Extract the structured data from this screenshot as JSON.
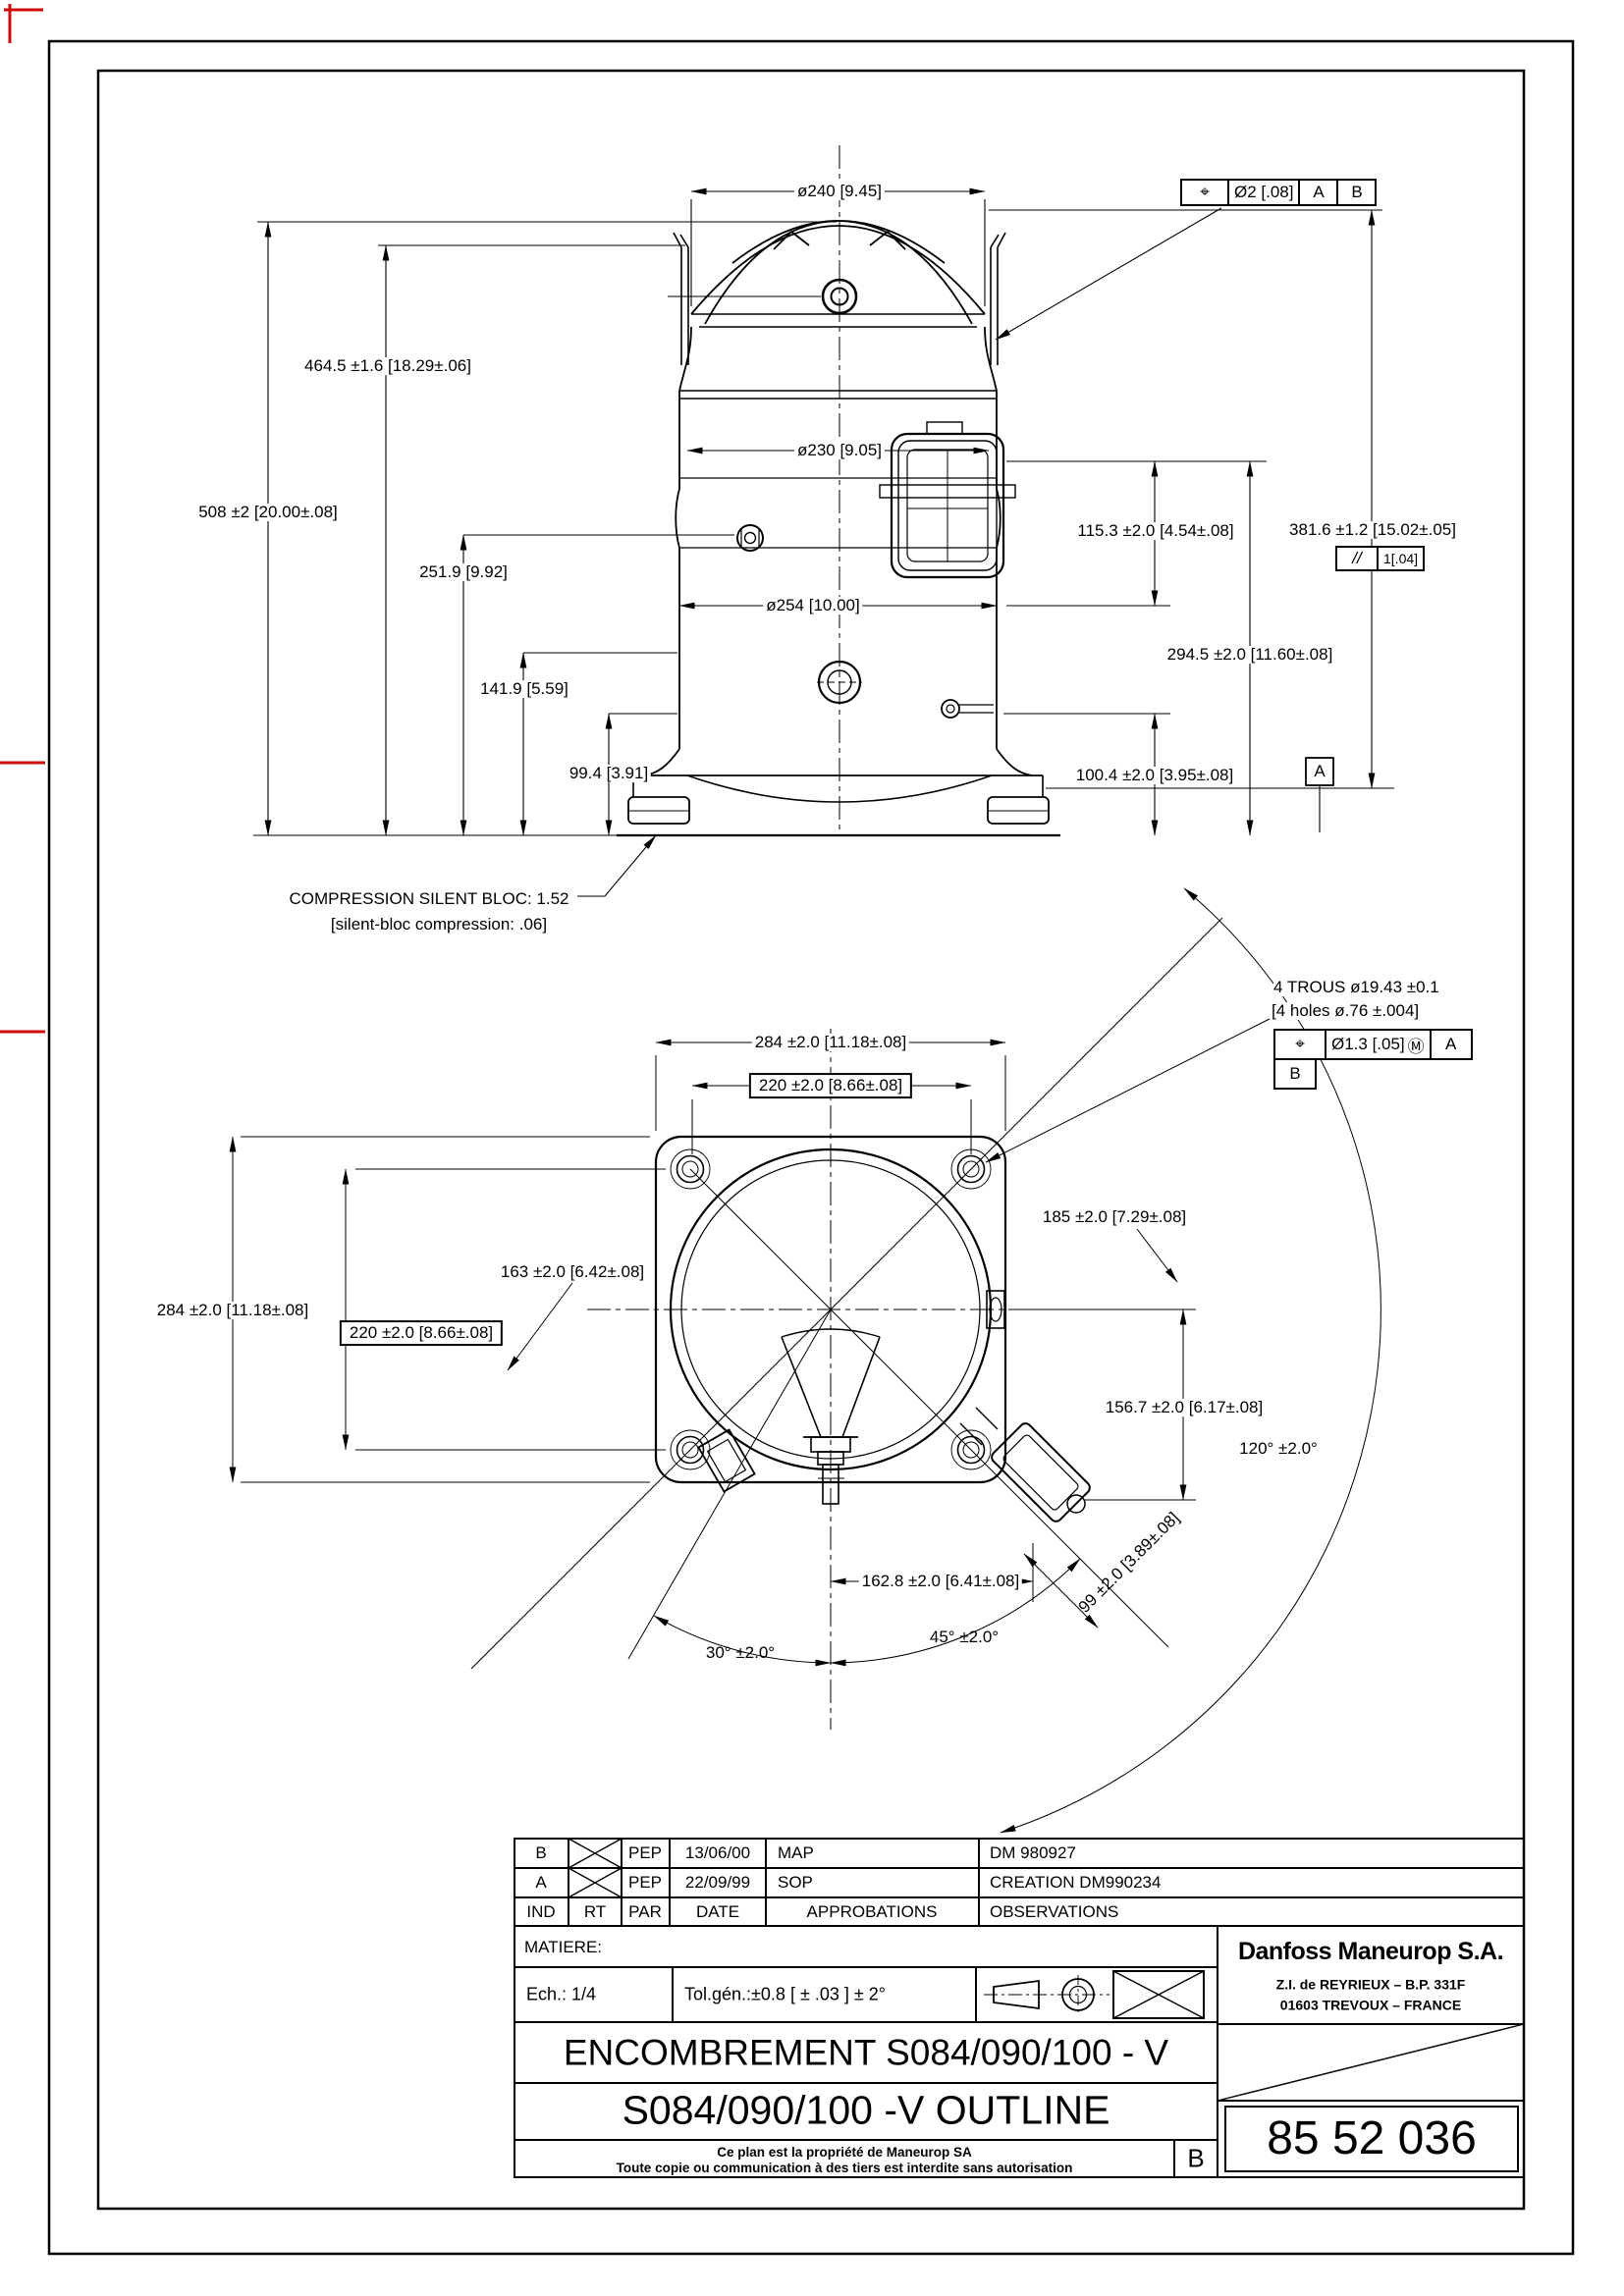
{
  "front_view": {
    "dim_dia240": "ø240 [9.45]",
    "dim_dia230": "ø230 [9.05]",
    "dim_dia254": "ø254 [10.00]",
    "dim_height_508": "508 ±2  [20.00±.08]",
    "dim_height_464": "464.5 ±1.6  [18.29±.06]",
    "dim_height_251": "251.9 [9.92]",
    "dim_height_141": "141.9 [5.59]",
    "dim_height_99": "99.4  [3.91]",
    "dim_height_115": "115.3 ±2.0  [4.54±.08]",
    "dim_height_381": "381.6 ±1.2  [15.02±.05]",
    "parallelism_frame": {
      "symbol": "//",
      "value": "1[.04]"
    },
    "dim_height_294": "294.5 ±2.0  [11.60±.08]",
    "dim_height_100": "100.4 ±2.0  [3.95±.08]",
    "datum_a": "A",
    "position_frame": {
      "symbol": "⌖",
      "value": "Ø2 [.08]",
      "datum_1": "A",
      "datum_2": "B"
    },
    "silent_bloc_note_fr": "COMPRESSION SILENT BLOC: 1.52",
    "silent_bloc_note_en": "[silent-bloc compression:  .06]"
  },
  "bottom_view": {
    "dim_width_284_top": "284 ±2.0  [11.18±.08]",
    "dim_width_220_top": "220 ±2.0  [8.66±.08]",
    "dim_height_284_left": "284 ±2.0  [11.18±.08]",
    "dim_height_220_left": "220 ±2.0  [8.66±.08]",
    "dim_163": "163 ±2.0  [6.42±.08]",
    "dim_185": "185 ±2.0  [7.29±.08]",
    "dim_156": "156.7 ±2.0  [6.17±.08]",
    "angle_120": "120° ±2.0°",
    "dim_162": "162.8 ±2.0  [6.41±.08]",
    "dim_99": "99 ±2.0  [3.89±.08]",
    "angle_45": "45° ±2.0°",
    "angle_30": "30° ±2.0°",
    "holes_note_fr": "4 TROUS ø19.43 ±0.1",
    "holes_note_en": "[4 holes ø.76 ±.004]",
    "position_frame": {
      "symbol": "⌖",
      "value": "Ø1.3 [.05]",
      "modifier": "Ⓜ",
      "datum_1": "A",
      "datum_2": "B"
    }
  },
  "title_block": {
    "revisions": [
      {
        "ind": "B",
        "par": "PEP",
        "date": "13/06/00",
        "approbation": "MAP",
        "observation": "DM 980927"
      },
      {
        "ind": "A",
        "par": "PEP",
        "date": "22/09/99",
        "approbation": "SOP",
        "observation": "CREATION DM990234"
      }
    ],
    "headers": {
      "ind": "IND",
      "rt": "RT",
      "par": "PAR",
      "date": "DATE",
      "approbations": "APPROBATIONS",
      "observations": "OBSERVATIONS"
    },
    "matiere_label": "MATIERE:",
    "scale_label": "Ech.: 1/4",
    "tolerance_label": "Tol.gén.:±0.8    [ ± .03 ]    ± 2°",
    "title_fr": "ENCOMBREMENT S084/090/100 - V",
    "title_en": "S084/090/100 -V   OUTLINE",
    "company": "Danfoss Maneurop S.A.",
    "address_line1": "Z.I. de REYRIEUX – B.P. 331F",
    "address_line2": "01603 TREVOUX – FRANCE",
    "property_note_line1": "Ce plan est la propriété de Maneurop SA",
    "property_note_line2": "Toute copie ou communication à des tiers est interdite sans autorisation",
    "revision_letter": "B",
    "drawing_number": "85 52 036"
  }
}
